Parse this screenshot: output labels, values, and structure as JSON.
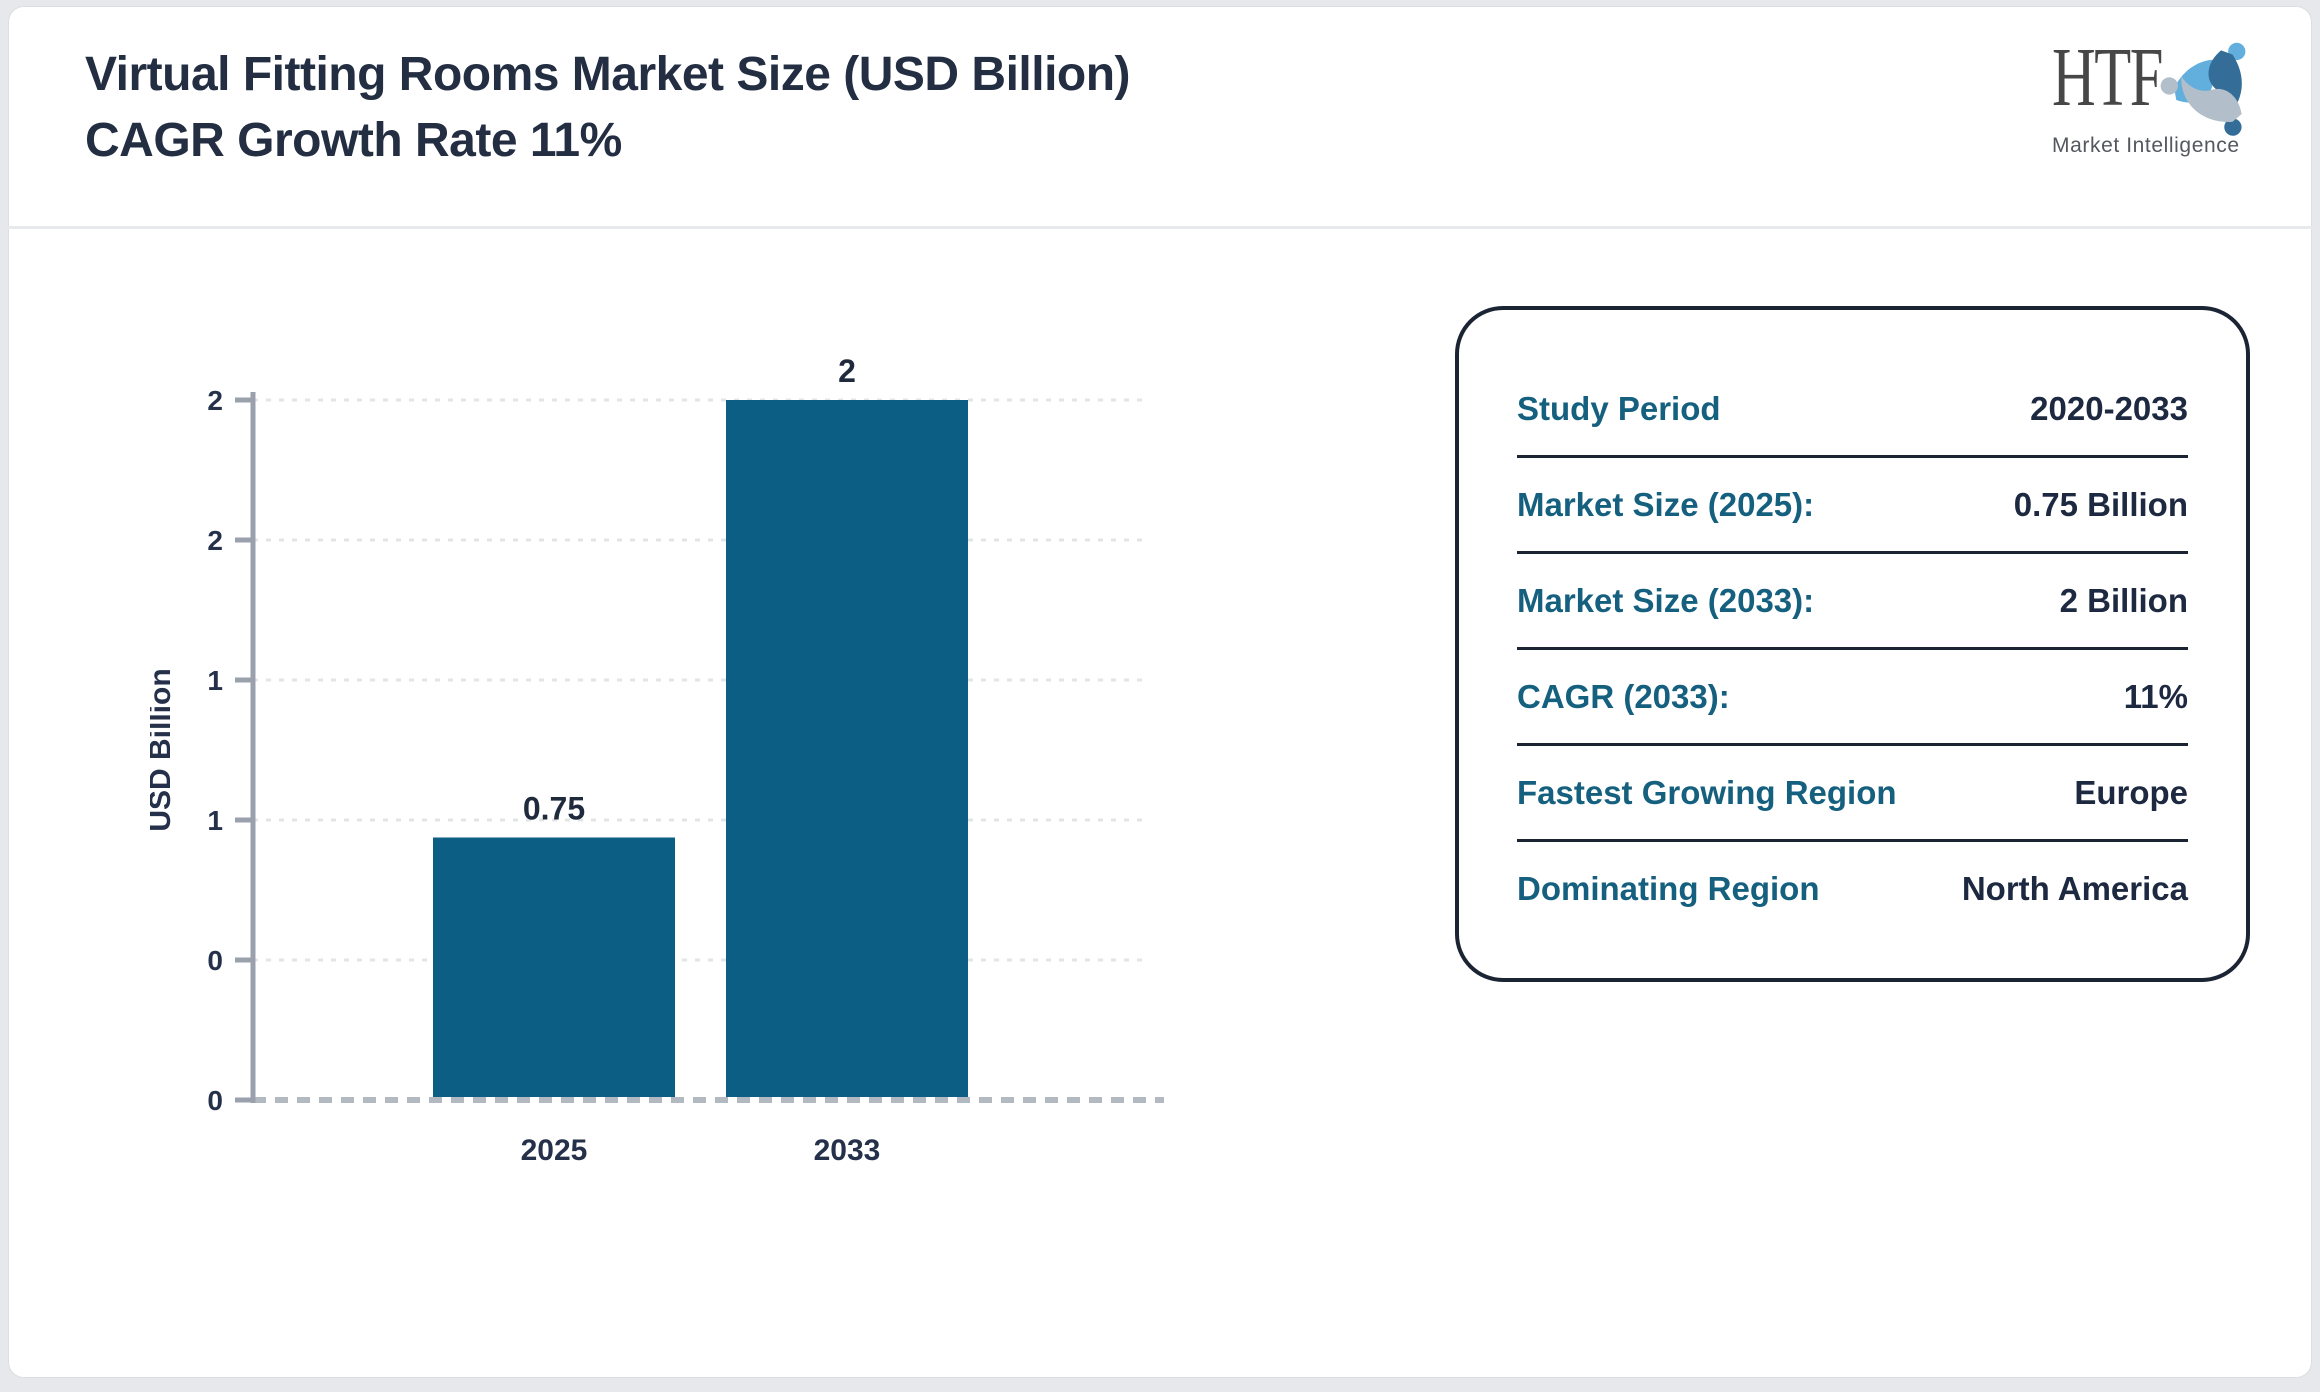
{
  "header": {
    "title_line1": "Virtual Fitting Rooms Market Size (USD Billion)",
    "title_line2": "CAGR Growth Rate 11%"
  },
  "logo": {
    "brand": "HTF",
    "tagline": "Market Intelligence",
    "colors": {
      "light_blue": "#62aedd",
      "dark_blue": "#336d98",
      "gray": "#b2bec9"
    }
  },
  "chart_data": {
    "type": "bar",
    "title": "Virtual Fitting Rooms Market Size (USD Billion)",
    "categories": [
      "2025",
      "2033"
    ],
    "values": [
      0.75,
      2
    ],
    "value_labels": [
      "0.75",
      "2"
    ],
    "xlabel": "",
    "ylabel": "USD Billion",
    "ylim": [
      0,
      2
    ],
    "yticks": [
      {
        "value": 2.0,
        "label": "2"
      },
      {
        "value": 1.6,
        "label": "2"
      },
      {
        "value": 1.2,
        "label": "1"
      },
      {
        "value": 0.8,
        "label": "1"
      },
      {
        "value": 0.4,
        "label": "0"
      },
      {
        "value": 0.0,
        "label": "0"
      }
    ],
    "grid": true,
    "legend": false,
    "bar_color": "#0d5e84"
  },
  "panel": {
    "rows": [
      {
        "label": "Study Period",
        "value": "2020-2033"
      },
      {
        "label": "Market Size (2025):",
        "value": "0.75 Billion"
      },
      {
        "label": "Market Size (2033):",
        "value": "2 Billion"
      },
      {
        "label": "CAGR (2033):",
        "value": "11%"
      },
      {
        "label": "Fastest Growing Region",
        "value": "Europe"
      },
      {
        "label": "Dominating Region",
        "value": "North America"
      }
    ]
  },
  "colors": {
    "page_bg": "#e7e8eb",
    "card_bg": "#ffffff",
    "title_text": "#232e42",
    "header_divider": "#e8e9ed",
    "bar_fill": "#0d5e84",
    "axis_line": "#9aa1ac",
    "gridline": "#e3e4e6",
    "baseline_dash": "#b3b9c1",
    "tick_text": "#25304a",
    "panel_border": "#1a2433",
    "panel_label": "#16607f",
    "panel_value": "#1d2940"
  }
}
